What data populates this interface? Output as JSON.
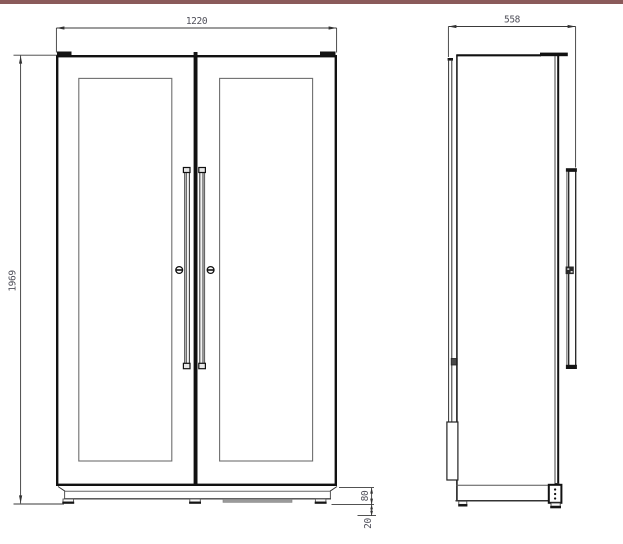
{
  "drawing": {
    "dimensions": {
      "front_width": "1220",
      "side_depth": "558",
      "overall_height": "1969",
      "base_height": "80",
      "foot_height": "20"
    },
    "colors": {
      "accent_bar": "#8a5a5a",
      "outline": "#111111",
      "dim_line": "#3a3a3a",
      "dim_text": "#50505a",
      "glass_border": "#6e6e6e",
      "vent_fill": "#9a9a9a",
      "background": "#ffffff"
    }
  }
}
